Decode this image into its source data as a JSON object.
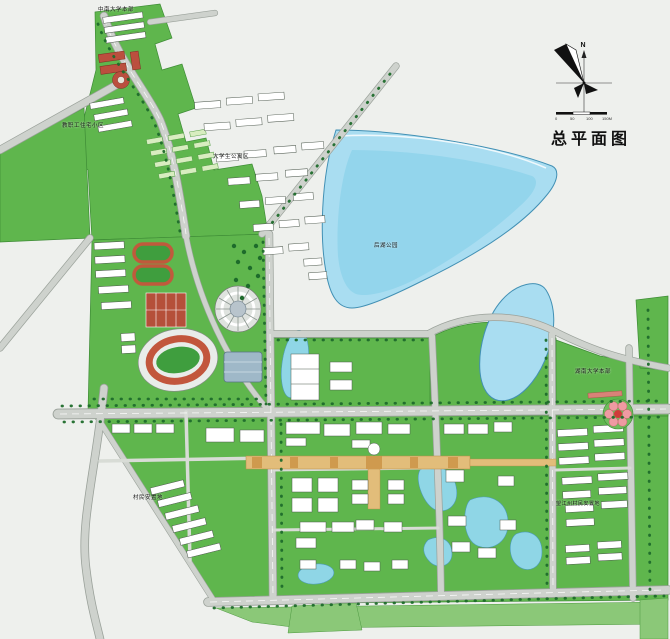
{
  "title": "总平面图",
  "compass": {
    "north_label": "N"
  },
  "scale_bar": {
    "ticks": [
      "0",
      "50",
      "100",
      "150M"
    ]
  },
  "map_labels": {
    "top_campus": "中南大学本部",
    "west_residential": "教职工住宅小区",
    "student_apartments": "大学生公寓区",
    "park": "后湖公园",
    "east_direction": "湖南大学本部",
    "villager_resettlement": "村民安置地",
    "east_resettlement": "望江州村民安置地"
  },
  "legend_colors": {
    "campus_green": "#5fb64d",
    "lake_blue": "#a9ddf1",
    "pond_blue": "#8fd6e6",
    "road_gray": "#ced2cd",
    "building_white": "#ffffff",
    "track_red": "#c05a3c",
    "axis_tan": "#e2bd7a",
    "tree_green": "#1d6b2b",
    "background_gray": "#eef0ed"
  }
}
